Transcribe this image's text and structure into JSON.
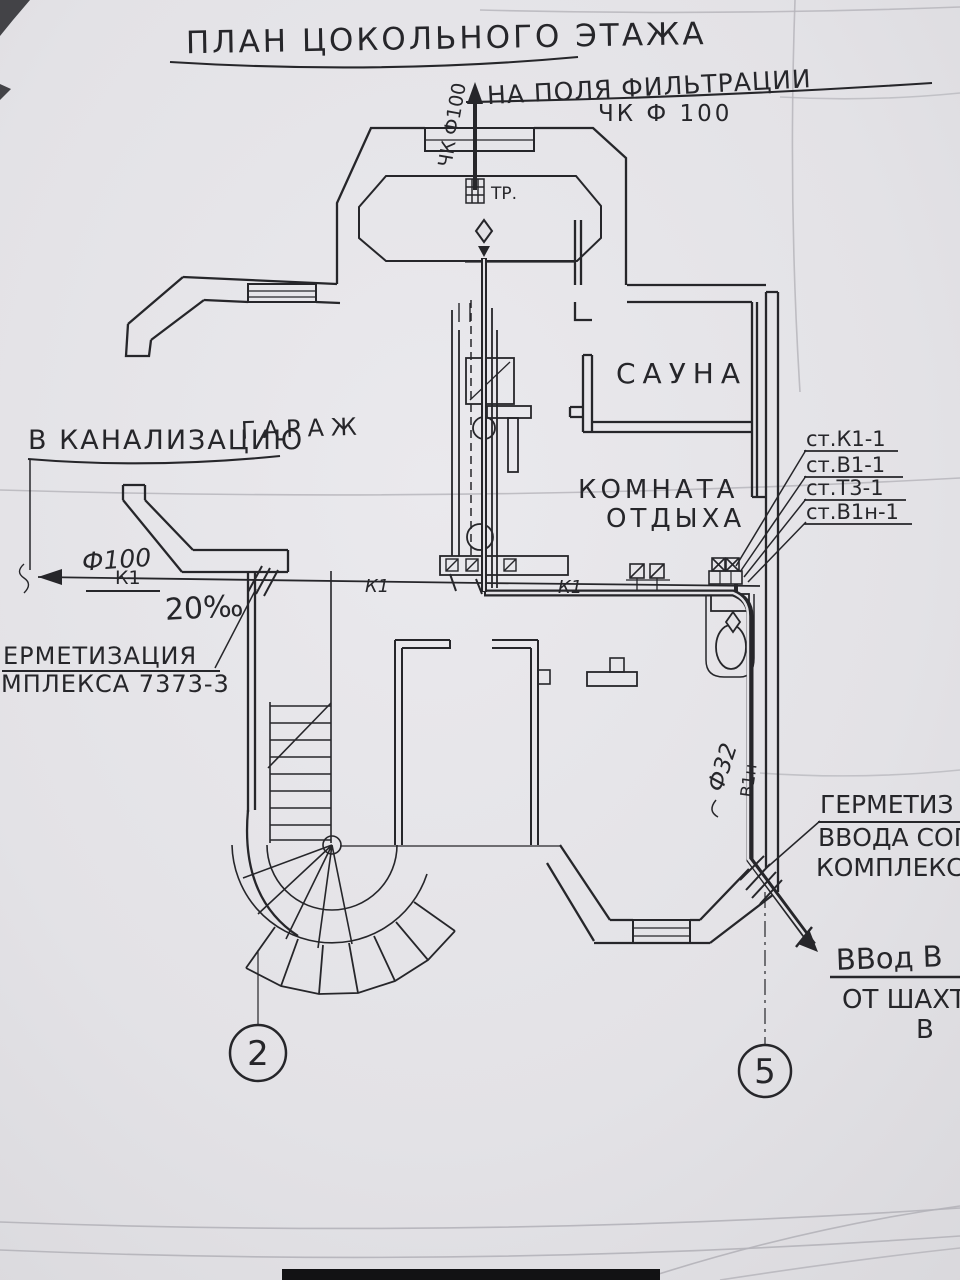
{
  "drawing": {
    "type": "scanned basement floor plan, hand-drawn sanitary engineering sheet",
    "colors": {
      "paper": "#e3e2e6",
      "ink": "#26262a",
      "crease": "#b4b3b9"
    }
  },
  "labels": {
    "title": "ПЛАН ЦОКОЛЬНОГО ЭТАЖА",
    "to_filtration": "НА ПОЛЯ ФИЛЬТРАЦИИ",
    "chk_f100": "ЧК Ф 100",
    "riser_top_pipe": "ЧК Ф100",
    "tr": "ТР.",
    "sauna": "САУНА",
    "garage": "ГАРАЖ",
    "to_sewer": "В КАНАЛИЗАЦИЮ",
    "lounge1": "КОМНАТА",
    "lounge2": "ОТДЫХА",
    "stack_k1": "ст.К1-1",
    "stack_v1": "ст.В1-1",
    "stack_t3": "ст.Т3-1",
    "stack_v1n": "ст.В1н-1",
    "dia100": "Ф100",
    "k1_left": "К1",
    "slope": "20‰",
    "k1_mid": "К1",
    "k1_right": "К1",
    "seal_left_1": "ЕРМЕТИЗАЦИЯ",
    "seal_left_2": "МПЛЕКСА 7373-3",
    "dia32": "Ф32",
    "v1n": "В1н",
    "seal_right_1": "ГЕРМЕТИЗ",
    "seal_right_2": "ВВОДА СОГ",
    "seal_right_3": "КОМПЛЕКСА",
    "inlet_1": "ВВод В",
    "inlet_2": "ОТ ШАХТ",
    "inlet_3": "В",
    "axis_left": "2",
    "axis_right": "5"
  }
}
